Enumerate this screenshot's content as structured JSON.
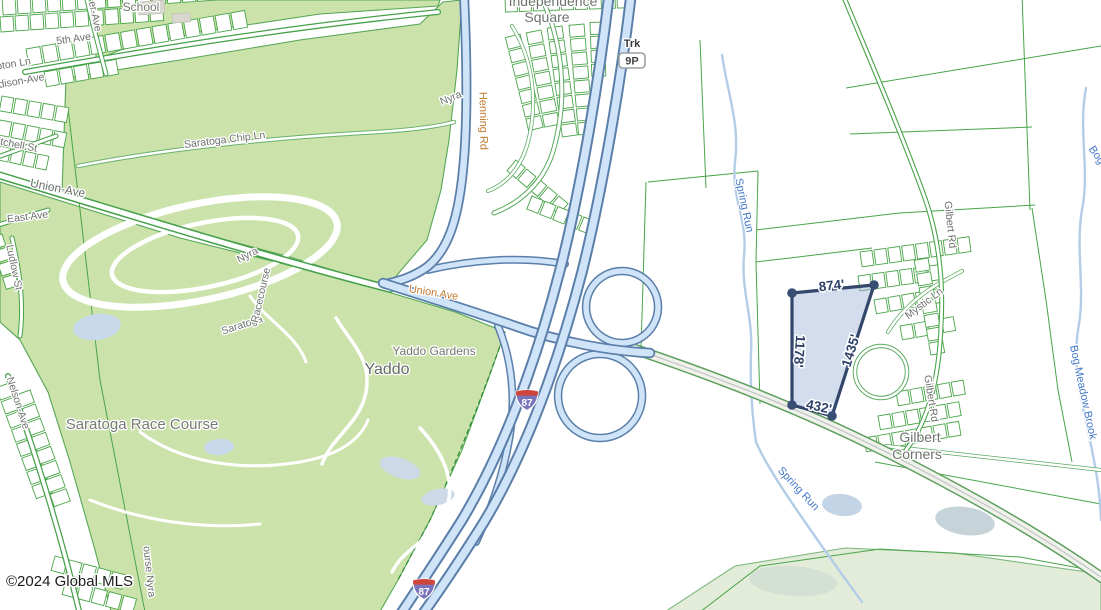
{
  "map": {
    "attribution": "©2024 Global MLS",
    "parcel": {
      "top_edge": "874'",
      "left_edge": "1178'",
      "right_edge": "1435'",
      "bottom_edge": "432'"
    },
    "shields": {
      "truck_route_prefix": "Trk",
      "truck_route_number": "9P",
      "interstate_number": "87",
      "interstate_number_2": "87"
    },
    "places": {
      "school": "School",
      "independence_square_line1": "Independence",
      "independence_square_line2": "Square",
      "yaddo_gardens": "Yaddo Gardens",
      "yaddo": "Yaddo",
      "saratoga_race_course": "Saratoga Race Course",
      "gilbert_corners_line1": "Gilbert",
      "gilbert_corners_line2": "Corners"
    },
    "streets": {
      "fifth_ave": "5th Ave",
      "pton_ln": "pton Ln",
      "madison_ave": "dison-Ave",
      "er_ave": "er-Ave",
      "mitchell_st": "itchell St",
      "union_ave_west": "Union-Ave",
      "east_ave": "East Ave",
      "ludlow_st": "Ludlow St",
      "nelson_ave": "Nelson-Ave",
      "saratoga_chip_ln": "Saratoga Chip Ln",
      "henning_rd": "Henning Rd",
      "union_ave": "Union Ave",
      "gilbert_rd_north": "Gilbert Rd",
      "gilbert_rd_south": "Gilbert Rd",
      "mystic_ln": "Mystic Ln",
      "racecourse_word1": "Saratoga",
      "racecourse_word2": "Racecourse",
      "racecourse_word3": "Nyra",
      "nyra_small": "Nyra",
      "racecourse_nyra_partial": "ourse Nyra"
    },
    "waterways": {
      "spring_run_north": "Spring Run",
      "spring_run_south": "Spring Run",
      "bog_meadow_brook": "Bog Meadow Brook",
      "bog_meadow_brook_partial": "Bog"
    },
    "colors": {
      "park_green": "#cbe3aa",
      "road_casing_green": "#46a04a",
      "highway_fill": "#cfe4f8",
      "highway_casing": "#5b7fa9",
      "water": "#b3cde8",
      "water_label": "#4478c8",
      "road_label_orange": "#c07a30",
      "parcel_fill": "#c4d4ea",
      "parcel_border": "#33476b",
      "label_gray": "#6c7070"
    }
  }
}
